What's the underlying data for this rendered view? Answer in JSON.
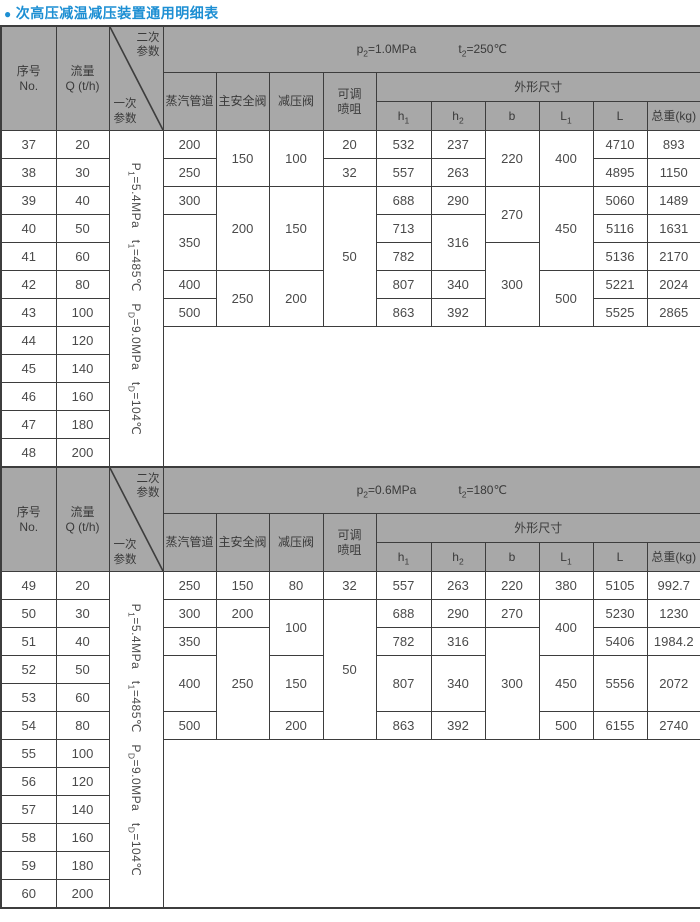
{
  "title": "次高压减温减压装置通用明细表",
  "colors": {
    "title_blue": "#1d8fd3",
    "header_gray": "#a8a8a8",
    "border_dark": "#3d3d3d",
    "cell_text": "#4a4a4a"
  },
  "labels": {
    "no": "序号\nNo.",
    "flow": "流量\nQ (t/h)",
    "secondary_params": "二次\n参数",
    "primary_params": "一次\n参数",
    "steam_pipe": "蒸汽管道",
    "main_safety_valve": "主安全阀",
    "pressure_reducing_valve": "减压阀",
    "adjustable_nozzle": "可调\n喷咀",
    "outline_dims": "外形尺寸",
    "h1": "h{1}",
    "h2": "h{2}",
    "b": "b",
    "L1": "L{1}",
    "L": "L",
    "weight": "总重(kg)"
  },
  "tables": [
    {
      "cond": {
        "p": "p{2}=1.0MPa",
        "t": "t{2}=250℃"
      },
      "rows": [
        {
          "cells": [
            {
              "v": "37"
            },
            {
              "v": "20"
            },
            {
              "v": "P{1}=5.4MPa   t{1}=485℃   P{D}=9.0MPa   t{D}=104℃",
              "cls": "vparam",
              "rs": 12
            },
            {
              "v": "200"
            },
            {
              "v": "150",
              "rs": 2
            },
            {
              "v": "100",
              "rs": 2
            },
            {
              "v": "20"
            },
            {
              "v": "532"
            },
            {
              "v": "237"
            },
            {
              "v": "220",
              "rs": 2
            },
            {
              "v": "400",
              "rs": 2
            },
            {
              "v": "4710"
            },
            {
              "v": "893"
            }
          ]
        },
        {
          "cells": [
            {
              "v": "38"
            },
            {
              "v": "30"
            },
            {
              "v": "250"
            },
            {
              "v": "32"
            },
            {
              "v": "557"
            },
            {
              "v": "263"
            },
            {
              "v": "4895"
            },
            {
              "v": "1150"
            }
          ]
        },
        {
          "cells": [
            {
              "v": "39"
            },
            {
              "v": "40"
            },
            {
              "v": "300"
            },
            {
              "v": "200",
              "rs": 3
            },
            {
              "v": "150",
              "rs": 3
            },
            {
              "v": "50",
              "rs": 5
            },
            {
              "v": "688"
            },
            {
              "v": "290"
            },
            {
              "v": "270",
              "rs": 2
            },
            {
              "v": "450",
              "rs": 3
            },
            {
              "v": "5060"
            },
            {
              "v": "1489"
            }
          ]
        },
        {
          "cells": [
            {
              "v": "40"
            },
            {
              "v": "50"
            },
            {
              "v": "350",
              "rs": 2
            },
            {
              "v": "713"
            },
            {
              "v": "316",
              "rs": 2
            },
            {
              "v": "5116"
            },
            {
              "v": "1631"
            }
          ]
        },
        {
          "cells": [
            {
              "v": "41"
            },
            {
              "v": "60"
            },
            {
              "v": "782"
            },
            {
              "v": "300",
              "rs": 3
            },
            {
              "v": "5136"
            },
            {
              "v": "2170"
            }
          ]
        },
        {
          "cells": [
            {
              "v": "42"
            },
            {
              "v": "80"
            },
            {
              "v": "400"
            },
            {
              "v": "250",
              "rs": 2
            },
            {
              "v": "200",
              "rs": 2
            },
            {
              "v": "807"
            },
            {
              "v": "340"
            },
            {
              "v": "500",
              "rs": 2
            },
            {
              "v": "5221"
            },
            {
              "v": "2024"
            }
          ]
        },
        {
          "cells": [
            {
              "v": "43"
            },
            {
              "v": "100"
            },
            {
              "v": "500"
            },
            {
              "v": "863"
            },
            {
              "v": "392"
            },
            {
              "v": "5525"
            },
            {
              "v": "2865"
            }
          ]
        },
        {
          "cells": [
            {
              "v": "44"
            },
            {
              "v": "120"
            },
            {
              "v": "",
              "cs": 10,
              "rs": 5,
              "cls": "blank"
            }
          ]
        },
        {
          "cells": [
            {
              "v": "45"
            },
            {
              "v": "140"
            }
          ]
        },
        {
          "cells": [
            {
              "v": "46"
            },
            {
              "v": "160"
            }
          ]
        },
        {
          "cells": [
            {
              "v": "47"
            },
            {
              "v": "180"
            }
          ]
        },
        {
          "cells": [
            {
              "v": "48"
            },
            {
              "v": "200"
            }
          ]
        }
      ]
    },
    {
      "cond": {
        "p": "p{2}=0.6MPa",
        "t": "t{2}=180℃"
      },
      "rows": [
        {
          "cells": [
            {
              "v": "49"
            },
            {
              "v": "20"
            },
            {
              "v": "P{1}=5.4MPa   t{1}=485℃   P{D}=9.0MPa   t{D}=104℃",
              "cls": "vparam",
              "rs": 12
            },
            {
              "v": "250"
            },
            {
              "v": "150"
            },
            {
              "v": "80"
            },
            {
              "v": "32"
            },
            {
              "v": "557"
            },
            {
              "v": "263"
            },
            {
              "v": "220"
            },
            {
              "v": "380"
            },
            {
              "v": "5105"
            },
            {
              "v": "992.7"
            }
          ]
        },
        {
          "cells": [
            {
              "v": "50"
            },
            {
              "v": "30"
            },
            {
              "v": "300"
            },
            {
              "v": "200"
            },
            {
              "v": "100",
              "rs": 2
            },
            {
              "v": "50",
              "rs": 5
            },
            {
              "v": "688"
            },
            {
              "v": "290"
            },
            {
              "v": "270"
            },
            {
              "v": "400",
              "rs": 2
            },
            {
              "v": "5230"
            },
            {
              "v": "1230"
            }
          ]
        },
        {
          "cells": [
            {
              "v": "51"
            },
            {
              "v": "40"
            },
            {
              "v": "350"
            },
            {
              "v": "250",
              "rs": 4
            },
            {
              "v": "782"
            },
            {
              "v": "316"
            },
            {
              "v": "300",
              "rs": 4
            },
            {
              "v": "5406"
            },
            {
              "v": "1984.2"
            }
          ]
        },
        {
          "cells": [
            {
              "v": "52"
            },
            {
              "v": "50"
            },
            {
              "v": "400",
              "rs": 2
            },
            {
              "v": "150",
              "rs": 2
            },
            {
              "v": "807",
              "rs": 2
            },
            {
              "v": "340",
              "rs": 2
            },
            {
              "v": "450",
              "rs": 2
            },
            {
              "v": "5556",
              "rs": 2
            },
            {
              "v": "2072",
              "rs": 2
            }
          ]
        },
        {
          "cells": [
            {
              "v": "53"
            },
            {
              "v": "60"
            }
          ]
        },
        {
          "cells": [
            {
              "v": "54"
            },
            {
              "v": "80"
            },
            {
              "v": "500"
            },
            {
              "v": "200"
            },
            {
              "v": "863"
            },
            {
              "v": "392"
            },
            {
              "v": "500"
            },
            {
              "v": "6155"
            },
            {
              "v": "2740"
            }
          ]
        },
        {
          "cells": [
            {
              "v": "55"
            },
            {
              "v": "100"
            },
            {
              "v": "",
              "cs": 10,
              "rs": 6,
              "cls": "blank"
            }
          ]
        },
        {
          "cells": [
            {
              "v": "56"
            },
            {
              "v": "120"
            }
          ]
        },
        {
          "cells": [
            {
              "v": "57"
            },
            {
              "v": "140"
            }
          ]
        },
        {
          "cells": [
            {
              "v": "58"
            },
            {
              "v": "160"
            }
          ]
        },
        {
          "cells": [
            {
              "v": "59"
            },
            {
              "v": "180"
            }
          ]
        },
        {
          "cells": [
            {
              "v": "60"
            },
            {
              "v": "200"
            }
          ]
        }
      ]
    }
  ]
}
